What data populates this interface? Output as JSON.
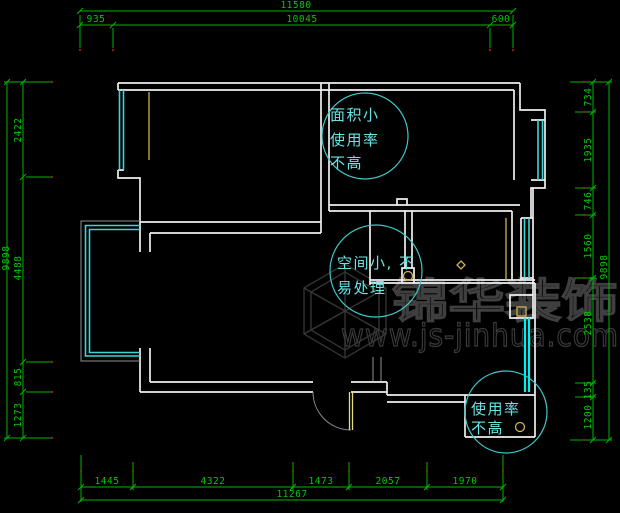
{
  "drawing": {
    "type": "apartment floor plan (CAD)",
    "background_color": "#000000",
    "wall_color": "#efefef",
    "window_color": "#3cd5d5",
    "glass_partition_color": "#00efef",
    "dimension_color": "#00c800",
    "annotation_color": "#67e4e4",
    "fixture_accent_color": "#cdb355",
    "watermark_color": "#3c3c3c"
  },
  "dimensions": {
    "top": {
      "total": "11580",
      "segments": [
        "935",
        "10045",
        "600"
      ]
    },
    "bottom": {
      "total": "11267",
      "segments": [
        "1445",
        "4322",
        "1473",
        "2057",
        "1970"
      ]
    },
    "left": {
      "total": "9898",
      "segments": [
        "2422",
        "4488",
        "815",
        "1273"
      ]
    },
    "right": {
      "total": "9898",
      "segments": [
        "734",
        "1935",
        "746",
        "1560",
        "2538",
        "135",
        "1200"
      ]
    }
  },
  "annotations": [
    {
      "shape": "circle",
      "lines": [
        "面积小",
        "使用率",
        "不高"
      ]
    },
    {
      "shape": "circle",
      "lines": [
        "空间小, 不",
        "易处理"
      ]
    },
    {
      "shape": "circle",
      "lines": [
        "使用率",
        "不高"
      ]
    }
  ],
  "watermark": {
    "logo": "cube-wireframe-logo",
    "brand": "锦华装饰",
    "url": "www.js-jinhua.com"
  }
}
